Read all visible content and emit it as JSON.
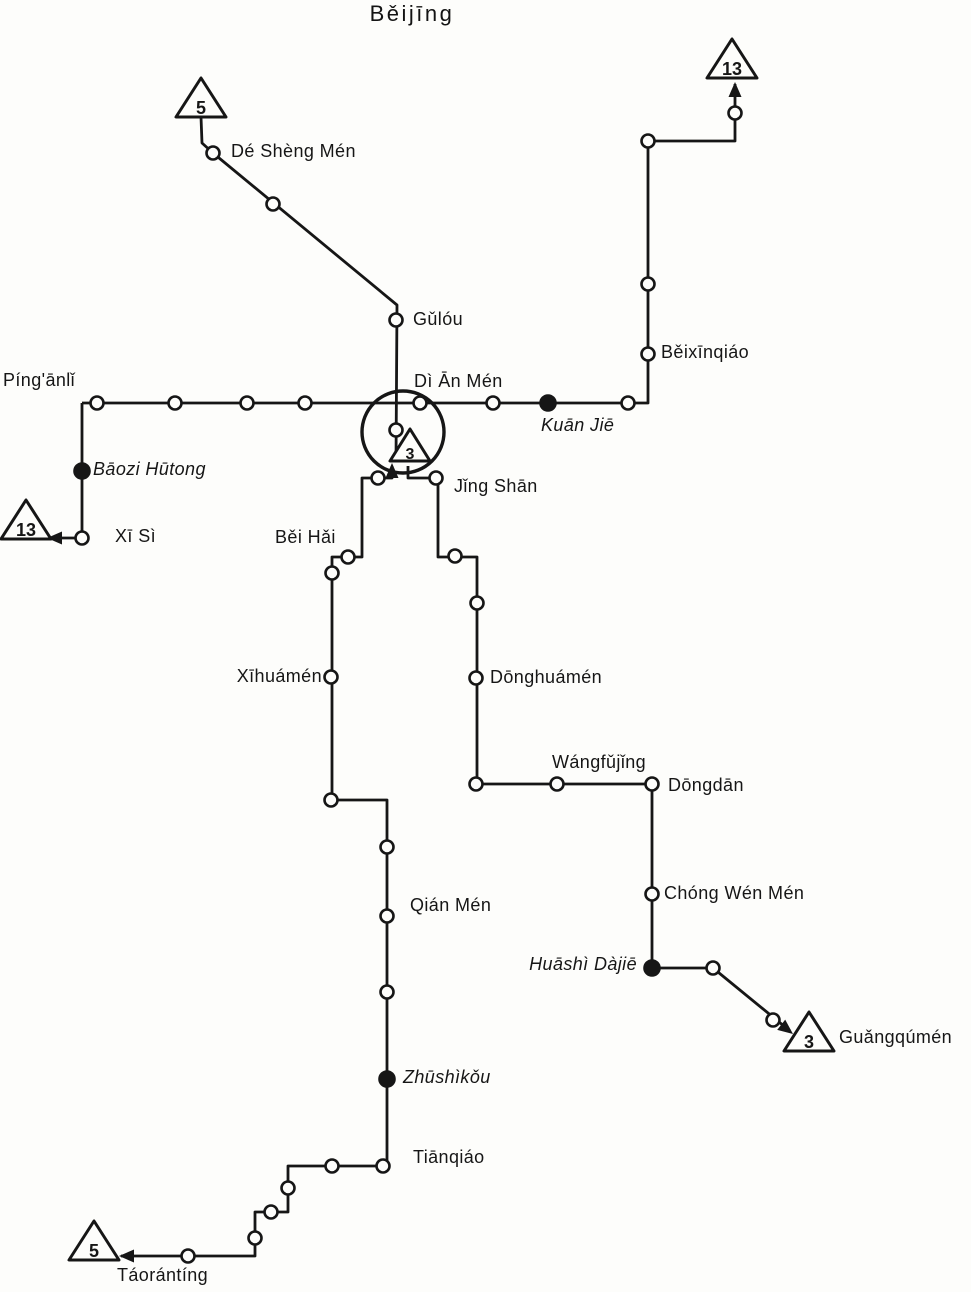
{
  "title": "Běijīng",
  "colors": {
    "ink": "#161616",
    "paper": "#fdfdfb"
  },
  "map": {
    "loop": {
      "cx": 403,
      "cy": 432,
      "r": 41
    },
    "routes": [
      {
        "id": "line-5-north",
        "points": [
          [
            201,
            117
          ],
          [
            202,
            143
          ],
          [
            213,
            153
          ],
          [
            397,
            305
          ],
          [
            396,
            461
          ]
        ]
      },
      {
        "id": "line-main-east-west",
        "points": [
          [
            82,
            403
          ],
          [
            648,
            403
          ],
          [
            648,
            141
          ],
          [
            735,
            141
          ],
          [
            735,
            84
          ]
        ]
      },
      {
        "id": "line-13-west",
        "points": [
          [
            82,
            403
          ],
          [
            82,
            538
          ],
          [
            49,
            538
          ]
        ]
      },
      {
        "id": "line-5-south",
        "points": [
          [
            392,
            466
          ],
          [
            392,
            478
          ],
          [
            362,
            478
          ],
          [
            362,
            557
          ],
          [
            332,
            557
          ],
          [
            332,
            800
          ],
          [
            387,
            800
          ],
          [
            387,
            1166
          ],
          [
            288,
            1166
          ],
          [
            288,
            1212
          ],
          [
            255,
            1212
          ],
          [
            255,
            1256
          ],
          [
            121,
            1256
          ]
        ]
      },
      {
        "id": "line-3-east",
        "points": [
          [
            408,
            466
          ],
          [
            408,
            478
          ],
          [
            438,
            478
          ],
          [
            438,
            557
          ],
          [
            477,
            557
          ],
          [
            477,
            784
          ],
          [
            652,
            784
          ],
          [
            652,
            968
          ],
          [
            713,
            968
          ],
          [
            790,
            1031
          ]
        ]
      }
    ],
    "stations": [
      {
        "x": 213,
        "y": 153,
        "name": "de-sheng-men"
      },
      {
        "x": 273,
        "y": 204
      },
      {
        "x": 396,
        "y": 320,
        "name": "gulou"
      },
      {
        "x": 396,
        "y": 430
      },
      {
        "x": 97,
        "y": 403,
        "name": "pinganli"
      },
      {
        "x": 175,
        "y": 403
      },
      {
        "x": 247,
        "y": 403
      },
      {
        "x": 305,
        "y": 403
      },
      {
        "x": 420,
        "y": 403,
        "name": "di-an-men"
      },
      {
        "x": 493,
        "y": 403
      },
      {
        "x": 548,
        "y": 403,
        "name": "kuan-jie",
        "filled": true
      },
      {
        "x": 628,
        "y": 403
      },
      {
        "x": 648,
        "y": 141
      },
      {
        "x": 648,
        "y": 284
      },
      {
        "x": 648,
        "y": 354,
        "name": "beixinqiao"
      },
      {
        "x": 735,
        "y": 113
      },
      {
        "x": 82,
        "y": 471,
        "name": "baozi-hutong",
        "filled": true
      },
      {
        "x": 82,
        "y": 538,
        "name": "xi-si"
      },
      {
        "x": 378,
        "y": 478
      },
      {
        "x": 348,
        "y": 557
      },
      {
        "x": 332,
        "y": 573
      },
      {
        "x": 331,
        "y": 677,
        "name": "xihuamen"
      },
      {
        "x": 331,
        "y": 800
      },
      {
        "x": 387,
        "y": 847
      },
      {
        "x": 387,
        "y": 916,
        "name": "qian-men"
      },
      {
        "x": 387,
        "y": 992
      },
      {
        "x": 387,
        "y": 1079,
        "name": "zhushikou",
        "filled": true
      },
      {
        "x": 383,
        "y": 1166,
        "name": "tianqiao"
      },
      {
        "x": 332,
        "y": 1166
      },
      {
        "x": 288,
        "y": 1188
      },
      {
        "x": 271,
        "y": 1212
      },
      {
        "x": 255,
        "y": 1238
      },
      {
        "x": 188,
        "y": 1256
      },
      {
        "x": 436,
        "y": 478,
        "name": "jing-shan"
      },
      {
        "x": 455,
        "y": 556
      },
      {
        "x": 477,
        "y": 603
      },
      {
        "x": 476,
        "y": 678,
        "name": "donghuamen"
      },
      {
        "x": 476,
        "y": 784
      },
      {
        "x": 557,
        "y": 784,
        "name": "wangfujing"
      },
      {
        "x": 652,
        "y": 784,
        "name": "dongdan"
      },
      {
        "x": 652,
        "y": 894,
        "name": "chong-wen-men"
      },
      {
        "x": 652,
        "y": 968,
        "name": "huashi-dajie",
        "filled": true
      },
      {
        "x": 713,
        "y": 968
      },
      {
        "x": 773,
        "y": 1020
      }
    ],
    "labels": [
      {
        "text": "Dé Shèng Mén",
        "x": 231,
        "y": 152
      },
      {
        "text": "Gǔlóu",
        "x": 413,
        "y": 320
      },
      {
        "text": "Dì Ān Mén",
        "x": 414,
        "y": 382
      },
      {
        "text": "Píng'ānlǐ",
        "x": 3,
        "y": 381
      },
      {
        "text": "Kuān Jiē",
        "x": 541,
        "y": 426,
        "italic": true
      },
      {
        "text": "Běixīnqiáo",
        "x": 661,
        "y": 353
      },
      {
        "text": "Bāozi Hūtong",
        "x": 93,
        "y": 470,
        "italic": true
      },
      {
        "text": "Xī Sì",
        "x": 115,
        "y": 537
      },
      {
        "text": "Běi Hǎi",
        "x": 275,
        "y": 538
      },
      {
        "text": "Jǐng Shān",
        "x": 454,
        "y": 487
      },
      {
        "text": "Xīhuámén",
        "x": 322,
        "y": 677,
        "anchor": "end"
      },
      {
        "text": "Dōnghuámén",
        "x": 490,
        "y": 678
      },
      {
        "text": "Wángfǔjǐng",
        "x": 552,
        "y": 763
      },
      {
        "text": "Dōngdān",
        "x": 668,
        "y": 786
      },
      {
        "text": "Qián Mén",
        "x": 410,
        "y": 906
      },
      {
        "text": "Chóng Wén Mén",
        "x": 664,
        "y": 894
      },
      {
        "text": "Huāshì Dàjiē",
        "x": 637,
        "y": 965,
        "italic": true,
        "anchor": "end"
      },
      {
        "text": "Guǎngqúmén",
        "x": 839,
        "y": 1038
      },
      {
        "text": "Zhūshìkǒu",
        "x": 403,
        "y": 1078,
        "italic": true
      },
      {
        "text": "Tiānqiáo",
        "x": 413,
        "y": 1158
      },
      {
        "text": "Táorántíng",
        "x": 117,
        "y": 1276
      }
    ],
    "terminals": [
      {
        "number": "5",
        "x": 201,
        "y": 99
      },
      {
        "number": "13",
        "x": 732,
        "y": 60
      },
      {
        "number": "13",
        "x": 26,
        "y": 521
      },
      {
        "number": "3",
        "x": 410,
        "y": 446,
        "small": true
      },
      {
        "number": "3",
        "x": 809,
        "y": 1033
      },
      {
        "number": "5",
        "x": 94,
        "y": 1242
      }
    ],
    "arrows": [
      {
        "x": 735,
        "y": 82,
        "angle": -90
      },
      {
        "x": 47,
        "y": 538,
        "angle": 180
      },
      {
        "x": 119,
        "y": 1256,
        "angle": 180
      },
      {
        "x": 793,
        "y": 1034,
        "angle": 38
      },
      {
        "x": 392,
        "y": 463,
        "angle": -90
      }
    ]
  }
}
